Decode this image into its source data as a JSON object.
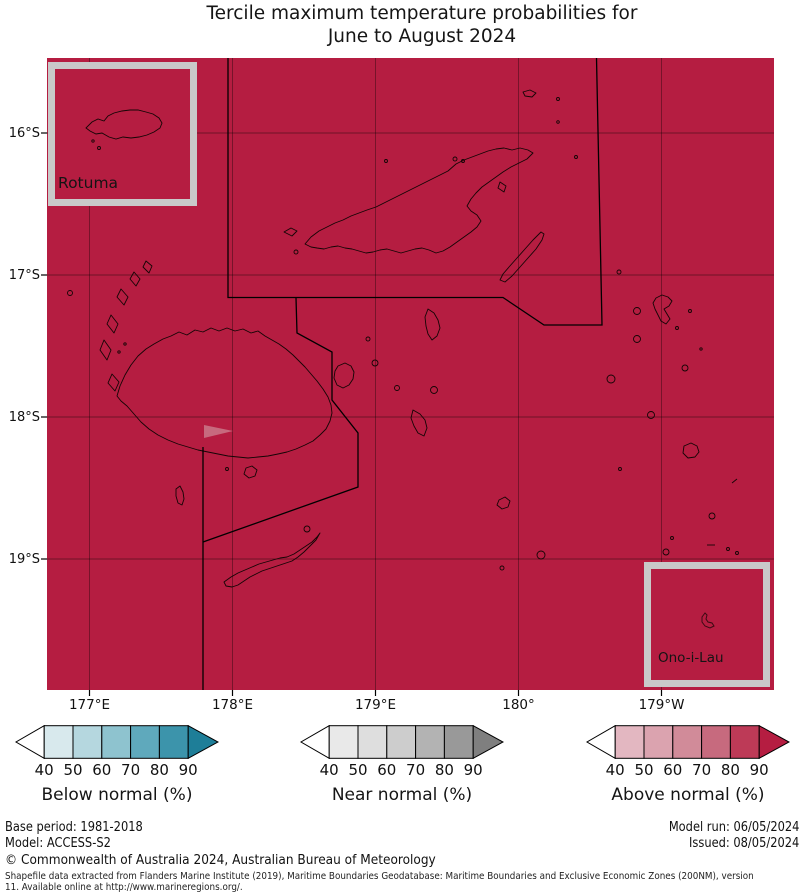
{
  "title": {
    "line1": "Tercile maximum temperature probabilities for",
    "line2": "June to August 2024"
  },
  "map": {
    "lat_labels": [
      "16°S",
      "17°S",
      "18°S",
      "19°S"
    ],
    "lon_labels": [
      "177°E",
      "178°E",
      "179°E",
      "180°",
      "179°W"
    ],
    "inset_rotuma_label": "Rotuma",
    "inset_ono_label": "Ono-i-Lau",
    "colors": {
      "above_90_fill": "#b51d41",
      "patch_fill": "#c76a7e"
    }
  },
  "legends": [
    {
      "title": "Below normal (%)",
      "values": [
        "40",
        "50",
        "60",
        "70",
        "80",
        "90"
      ],
      "colors": [
        "#d8e9ed",
        "#b5d7df",
        "#8ec3cf",
        "#5fa9bc",
        "#3c94ab"
      ],
      "arrow_color": "#1e7e98"
    },
    {
      "title": "Near normal (%)",
      "values": [
        "40",
        "50",
        "60",
        "70",
        "80",
        "90"
      ],
      "colors": [
        "#e9e9e9",
        "#dedede",
        "#cdcdcd",
        "#b3b3b3",
        "#999999"
      ],
      "arrow_color": "#7f7f7f"
    },
    {
      "title": "Above normal (%)",
      "values": [
        "40",
        "50",
        "60",
        "70",
        "80",
        "90"
      ],
      "colors": [
        "#e3b7c1",
        "#dba3af",
        "#d18b99",
        "#c76a7e",
        "#bd3a57"
      ],
      "arrow_color": "#b51d41"
    }
  ],
  "footer": {
    "base_period": "Base period: 1981-2018",
    "model": "Model: ACCESS-S2",
    "model_run": "Model run: 06/05/2024",
    "issued": "Issued: 08/05/2024",
    "copyright": "© Commonwealth of Australia 2024, Australian Bureau of Meteorology",
    "shapefile_line1": "Shapefile data extracted from Flanders Marine Institute (2019), Maritime Boundaries Geodatabase: Maritime Boundaries and Exclusive Economic Zones (200NM), version",
    "shapefile_line2": "11. Available online at http://www.marineregions.org/."
  }
}
